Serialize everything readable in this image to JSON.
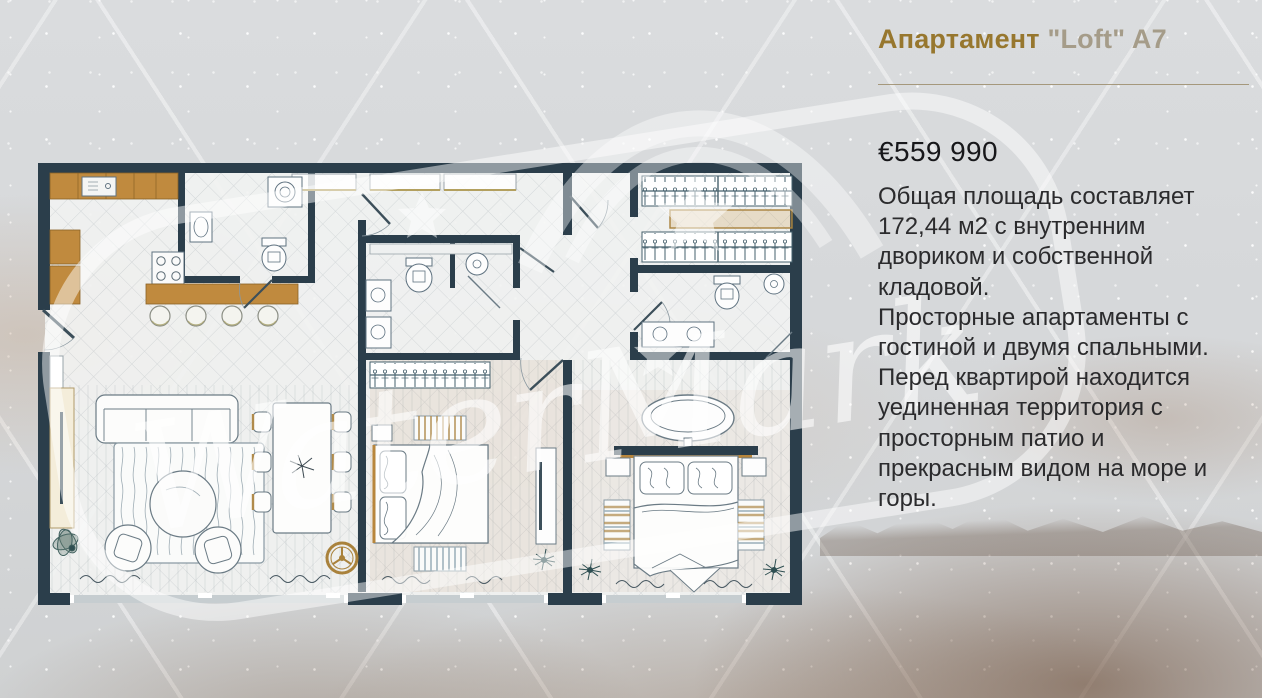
{
  "listing": {
    "title_part1": "Апартамент",
    "title_part2": "\"Loft\" A7",
    "price": "€559 990",
    "description_lines": [
      "Общая площадь составляет",
      "172,44 м2 с внутренним",
      "двориком и собственной",
      "кладовой.",
      "Просторные апартаменты с",
      "гостиной и двумя спальными.",
      "Перед квартирой находится",
      "уединенная территория с",
      "просторным патио и",
      "прекрасным видом на море и",
      "горы."
    ]
  },
  "watermark": {
    "text": "WaterMark"
  },
  "floorplan": {
    "rooms": [
      "kitchen",
      "living-dining-room",
      "bedroom-1",
      "bedroom-2",
      "bathroom-1",
      "bathroom-2",
      "bathroom-3",
      "walk-in-closet",
      "hallway"
    ],
    "features": [
      "kitchen-island",
      "bar-stools",
      "sofa",
      "coffee-table",
      "armchairs",
      "dining-table",
      "tv-units",
      "double-beds",
      "freestanding-bathtub",
      "wardrobe-hangers",
      "washing-machine",
      "rugs",
      "plants",
      "sliding-windows"
    ]
  },
  "colors": {
    "title_accent": "#97772e",
    "title_secondary": "#a59c89",
    "divider": "#9b8c6b",
    "body_text": "#2b2b2d",
    "wall": "#2b3e4b",
    "wood": "#c08a3e",
    "background": "#d7dadc"
  }
}
